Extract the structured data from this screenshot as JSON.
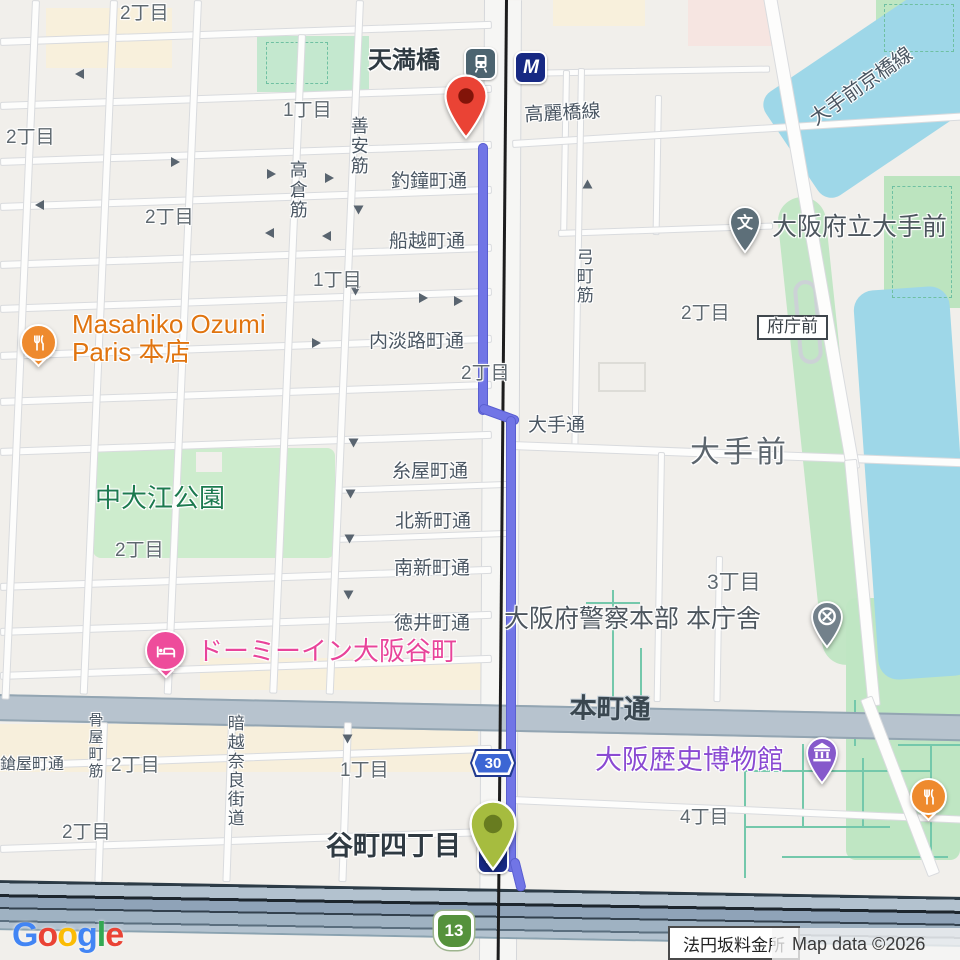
{
  "attribution": {
    "logo_text": "Google",
    "logo_colors": [
      "#4285F4",
      "#EA4335",
      "#FBBC05",
      "#4285F4",
      "#34A853",
      "#EA4335"
    ],
    "map_data": "Map data ©2026",
    "toll_gate_label": "法円坂料金所"
  },
  "route": {
    "color": "#7175e6",
    "origin": "谷町四丁目",
    "destination": "天満橋"
  },
  "shields": [
    {
      "kind": "prefectural-route",
      "number": "30"
    },
    {
      "kind": "expressway",
      "number": "13"
    }
  ],
  "stations": {
    "temmabashi": "天満橋",
    "tanimachi4": "谷町四丁目",
    "metro_logo": "M"
  },
  "pins": {
    "school_glyph": "文"
  },
  "map_labels": [
    {
      "t": "釣鐘町通",
      "k": "st",
      "x": 391,
      "y": 172
    },
    {
      "t": "船越町通",
      "k": "st",
      "x": 389,
      "y": 232
    },
    {
      "t": "内淡路町通",
      "k": "st",
      "x": 369,
      "y": 332
    },
    {
      "t": "糸屋町通",
      "k": "st",
      "x": 392,
      "y": 462
    },
    {
      "t": "北新町通",
      "k": "st",
      "x": 395,
      "y": 512
    },
    {
      "t": "南新町通",
      "k": "st",
      "x": 394,
      "y": 559
    },
    {
      "t": "徳井町通",
      "k": "st",
      "x": 394,
      "y": 614
    },
    {
      "t": "高麗橋線",
      "k": "st",
      "x": 524,
      "y": 106,
      "r": -3
    },
    {
      "t": "大手通",
      "k": "st",
      "x": 528,
      "y": 416
    },
    {
      "t": "鎗屋町通",
      "k": "st",
      "x": 0,
      "y": 756,
      "s": 16
    },
    {
      "t": "大手前京橋線",
      "k": "st",
      "x": 806,
      "y": 112,
      "r": -35,
      "s": 20
    },
    {
      "t": "本町通",
      "k": "road",
      "x": 570,
      "y": 694,
      "r": 1.2
    },
    {
      "t": "高倉筋",
      "k": "sv",
      "x": 287,
      "y": 160
    },
    {
      "t": "善安筋",
      "k": "sv",
      "x": 348,
      "y": 116
    },
    {
      "t": "弓町筋",
      "k": "sv",
      "x": 573,
      "y": 248,
      "s": 17
    },
    {
      "t": "骨屋町筋",
      "k": "sv",
      "x": 86,
      "y": 712,
      "s": 15
    },
    {
      "t": "暗越奈良街道",
      "k": "sv",
      "x": 224,
      "y": 714,
      "s": 17
    },
    {
      "t": "2丁目",
      "k": "d",
      "x": 120,
      "y": 4
    },
    {
      "t": "1丁目",
      "k": "d",
      "x": 283,
      "y": 101
    },
    {
      "t": "2丁目",
      "k": "d",
      "x": 6,
      "y": 128
    },
    {
      "t": "2丁目",
      "k": "d",
      "x": 145,
      "y": 208
    },
    {
      "t": "1丁目",
      "k": "d",
      "x": 313,
      "y": 271
    },
    {
      "t": "2丁目",
      "k": "d",
      "x": 461,
      "y": 364
    },
    {
      "t": "2丁目",
      "k": "d",
      "x": 681,
      "y": 304
    },
    {
      "t": "2丁目",
      "k": "d",
      "x": 115,
      "y": 541
    },
    {
      "t": "3丁目",
      "k": "d",
      "x": 707,
      "y": 571,
      "s": 21
    },
    {
      "t": "4丁目",
      "k": "d",
      "x": 680,
      "y": 808
    },
    {
      "t": "1丁目",
      "k": "d",
      "x": 340,
      "y": 761
    },
    {
      "t": "2丁目",
      "k": "d",
      "x": 111,
      "y": 756
    },
    {
      "t": "2丁目",
      "k": "d",
      "x": 62,
      "y": 823
    },
    {
      "t": "大手前",
      "k": "area",
      "x": 690,
      "y": 436
    },
    {
      "t": "中大江公園",
      "k": "park",
      "x": 95,
      "y": 484
    },
    {
      "t": "Masahiko Ozumi",
      "k": "po",
      "x": 72,
      "y": 310
    },
    {
      "t": "Paris 本店",
      "k": "po",
      "x": 72,
      "y": 338
    },
    {
      "t": "ドーミーイン大阪谷町",
      "k": "pp",
      "x": 197,
      "y": 637
    },
    {
      "t": "大阪歴史博物館",
      "k": "pv",
      "x": 595,
      "y": 746
    },
    {
      "t": "大阪府警察本部 本庁舎",
      "k": "pg",
      "x": 504,
      "y": 606
    },
    {
      "t": "大阪府立大手前",
      "k": "pg",
      "x": 772,
      "y": 214
    },
    {
      "t": "天満橋",
      "k": "station",
      "x": 368,
      "y": 48
    },
    {
      "t": "谷町四丁目",
      "k": "station",
      "x": 326,
      "y": 832,
      "s": 27
    },
    {
      "t": "府庁前",
      "k": "bus",
      "x": 757,
      "y": 315
    }
  ],
  "one_way_arrows": [
    {
      "x": 75,
      "y": 69,
      "r": 180
    },
    {
      "x": 171,
      "y": 157,
      "r": 0
    },
    {
      "x": 267,
      "y": 169,
      "r": 0
    },
    {
      "x": 325,
      "y": 173,
      "r": 0
    },
    {
      "x": 35,
      "y": 200,
      "r": 180
    },
    {
      "x": 354,
      "y": 205,
      "r": 90
    },
    {
      "x": 265,
      "y": 228,
      "r": 180
    },
    {
      "x": 322,
      "y": 231,
      "r": 180
    },
    {
      "x": 351,
      "y": 286,
      "r": 90
    },
    {
      "x": 419,
      "y": 293,
      "r": 0
    },
    {
      "x": 454,
      "y": 296,
      "r": 0
    },
    {
      "x": 312,
      "y": 338,
      "r": 0
    },
    {
      "x": 583,
      "y": 179,
      "r": -90
    },
    {
      "x": 349,
      "y": 438,
      "r": 90
    },
    {
      "x": 346,
      "y": 489,
      "r": 90
    },
    {
      "x": 345,
      "y": 534,
      "r": 90
    },
    {
      "x": 344,
      "y": 590,
      "r": 90
    },
    {
      "x": 343,
      "y": 734,
      "r": 90
    }
  ]
}
